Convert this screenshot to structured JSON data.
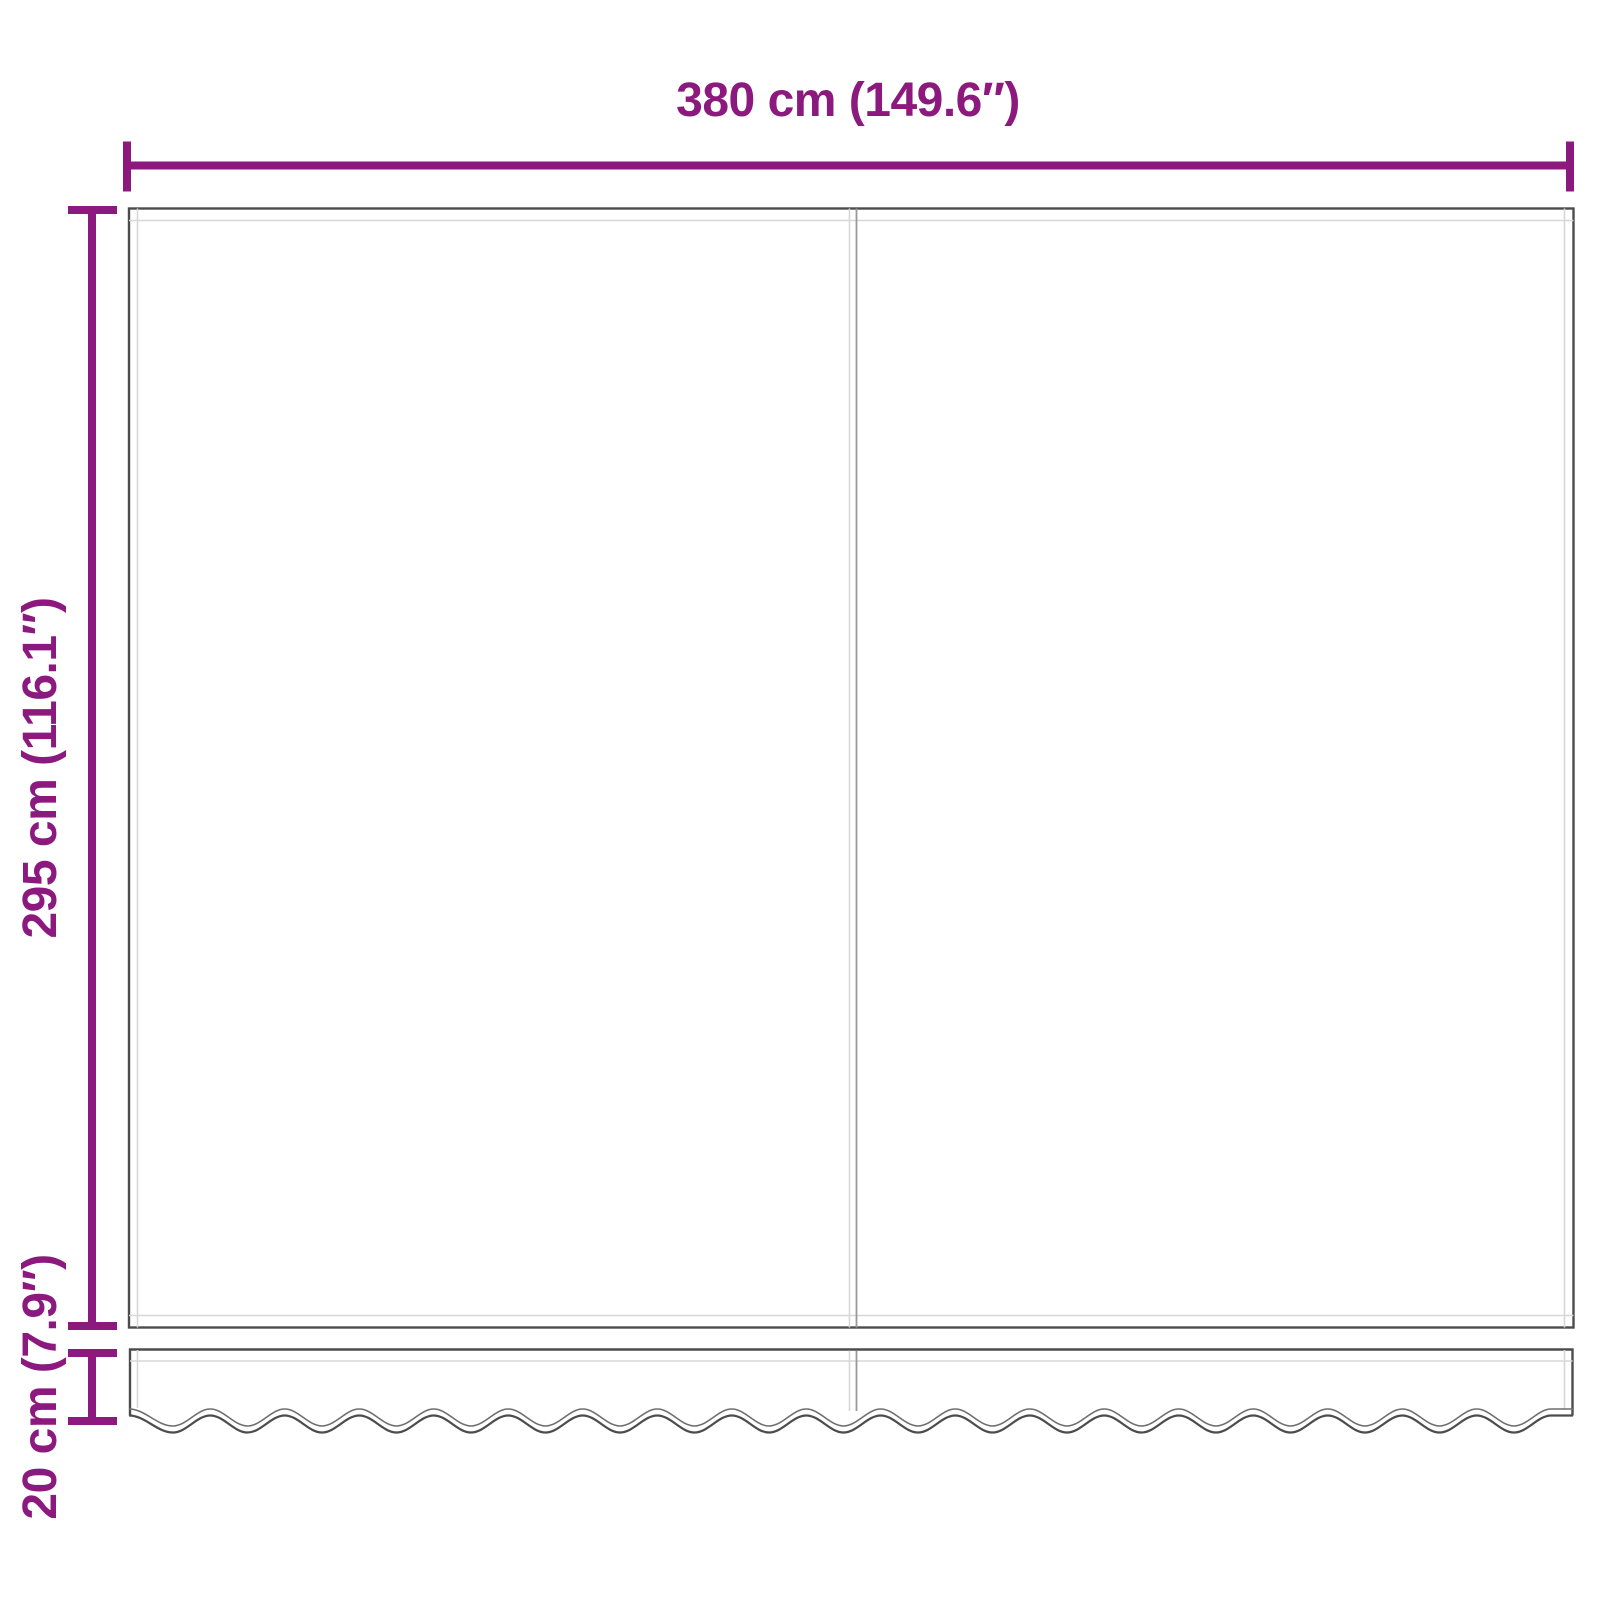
{
  "diagram": {
    "subject": "awning-replacement-fabric-with-valance",
    "panels": {
      "main_panel": "fabric canopy panel with center seam and hem inset lines",
      "valance_panel": "bottom valance strip with scalloped wavy edge and center seam"
    }
  },
  "dimensions": {
    "width": {
      "cm": "380",
      "inch": "149.6",
      "label": "380 cm (149.6″)"
    },
    "height": {
      "cm": "295",
      "inch": "116.1",
      "label": "295 cm (116.1″)"
    },
    "valance_height": {
      "cm": "20",
      "inch": "7.9",
      "label": "20 cm (7.9″)"
    }
  },
  "colors": {
    "accent": "#8C1A7E",
    "line-dark": "#4C4C4C",
    "line-mid": "#9A9A9A",
    "line-light": "#D7D7D7",
    "wave-top": "#6E6E6E",
    "background": "#FFFFFF"
  }
}
